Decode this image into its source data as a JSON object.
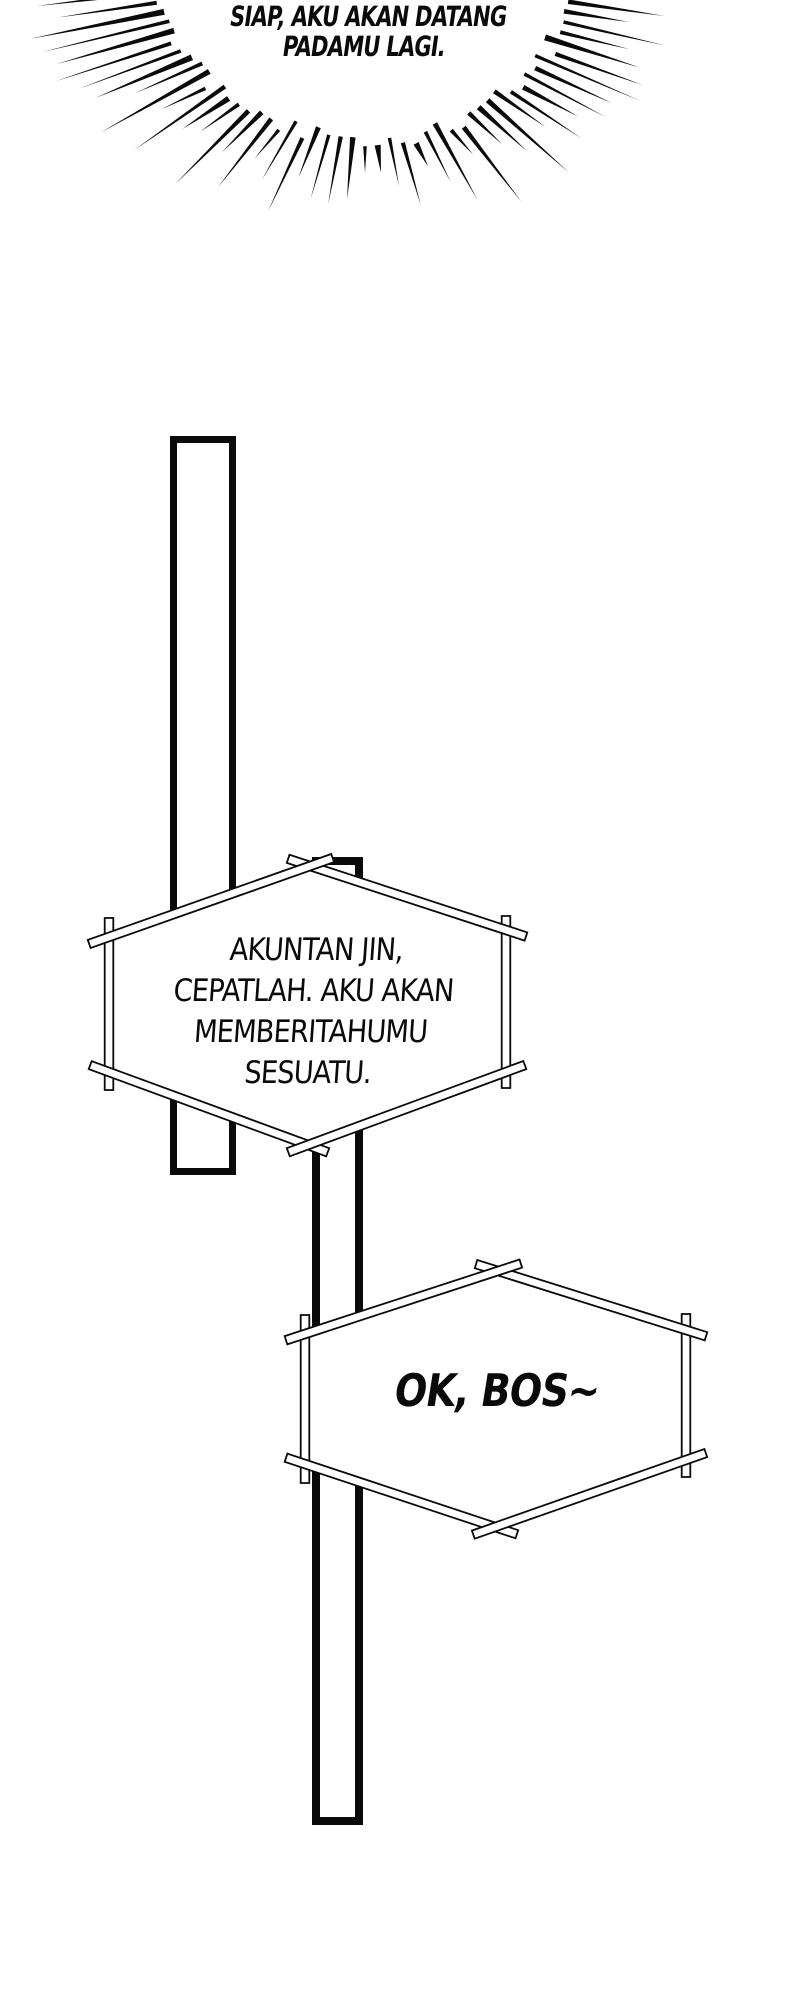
{
  "page": {
    "background": "#ffffff",
    "ink": "#0a0a0a"
  },
  "burst_bubble": {
    "text_lines": [
      "SIAP, AKU AKAN DATANG",
      "PADAMU LAGI."
    ]
  },
  "bubble_akuntan": {
    "text_lines": [
      "AKUNTAN JIN,",
      "CEPATLAH. AKU AKAN",
      "MEMBERITAHUMU",
      "SESUATU."
    ]
  },
  "bubble_ok_bos": {
    "text_lines": [
      "OK, BOS~"
    ]
  }
}
